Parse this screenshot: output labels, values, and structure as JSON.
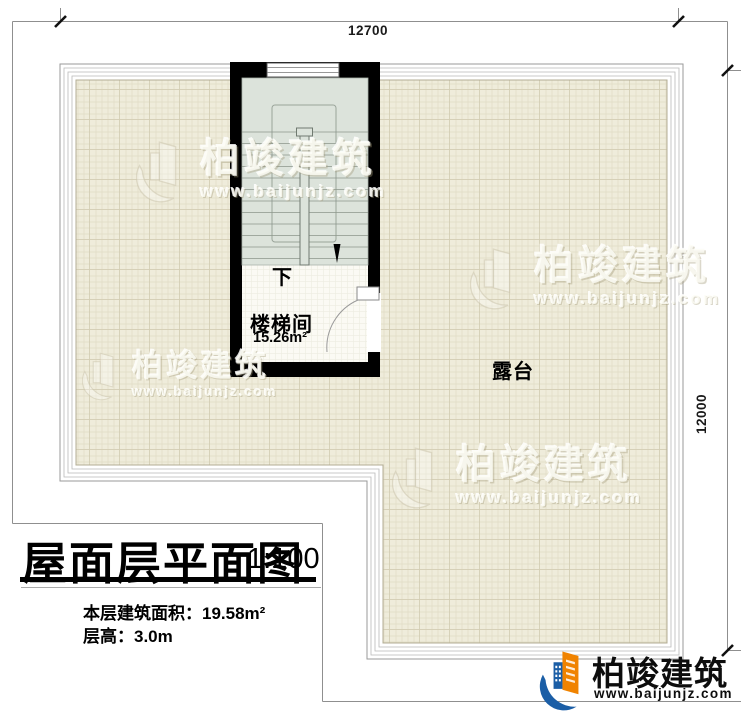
{
  "plan": {
    "dim_top": "12700",
    "dim_right": "12000",
    "stair_direction": "下",
    "stair_room": "楼梯间",
    "stair_area": "15.26m²",
    "terrace": "露台"
  },
  "title_block": {
    "title": "屋面层平面图",
    "scale": "1:100",
    "area_line": "本层建筑面积：19.58m²",
    "height_line": "层高：3.0m"
  },
  "watermark": {
    "name": "柏竣建筑",
    "url": "www.baijunjz.com"
  },
  "logo": {
    "name": "柏竣建筑",
    "url": "www.baijunjz.com"
  },
  "colors": {
    "wall": "#000000",
    "roof_tile": "#efecdb",
    "stair_floor": "#dce3db",
    "logo_orange": "#f08300",
    "logo_blue": "#1b5ea6"
  }
}
